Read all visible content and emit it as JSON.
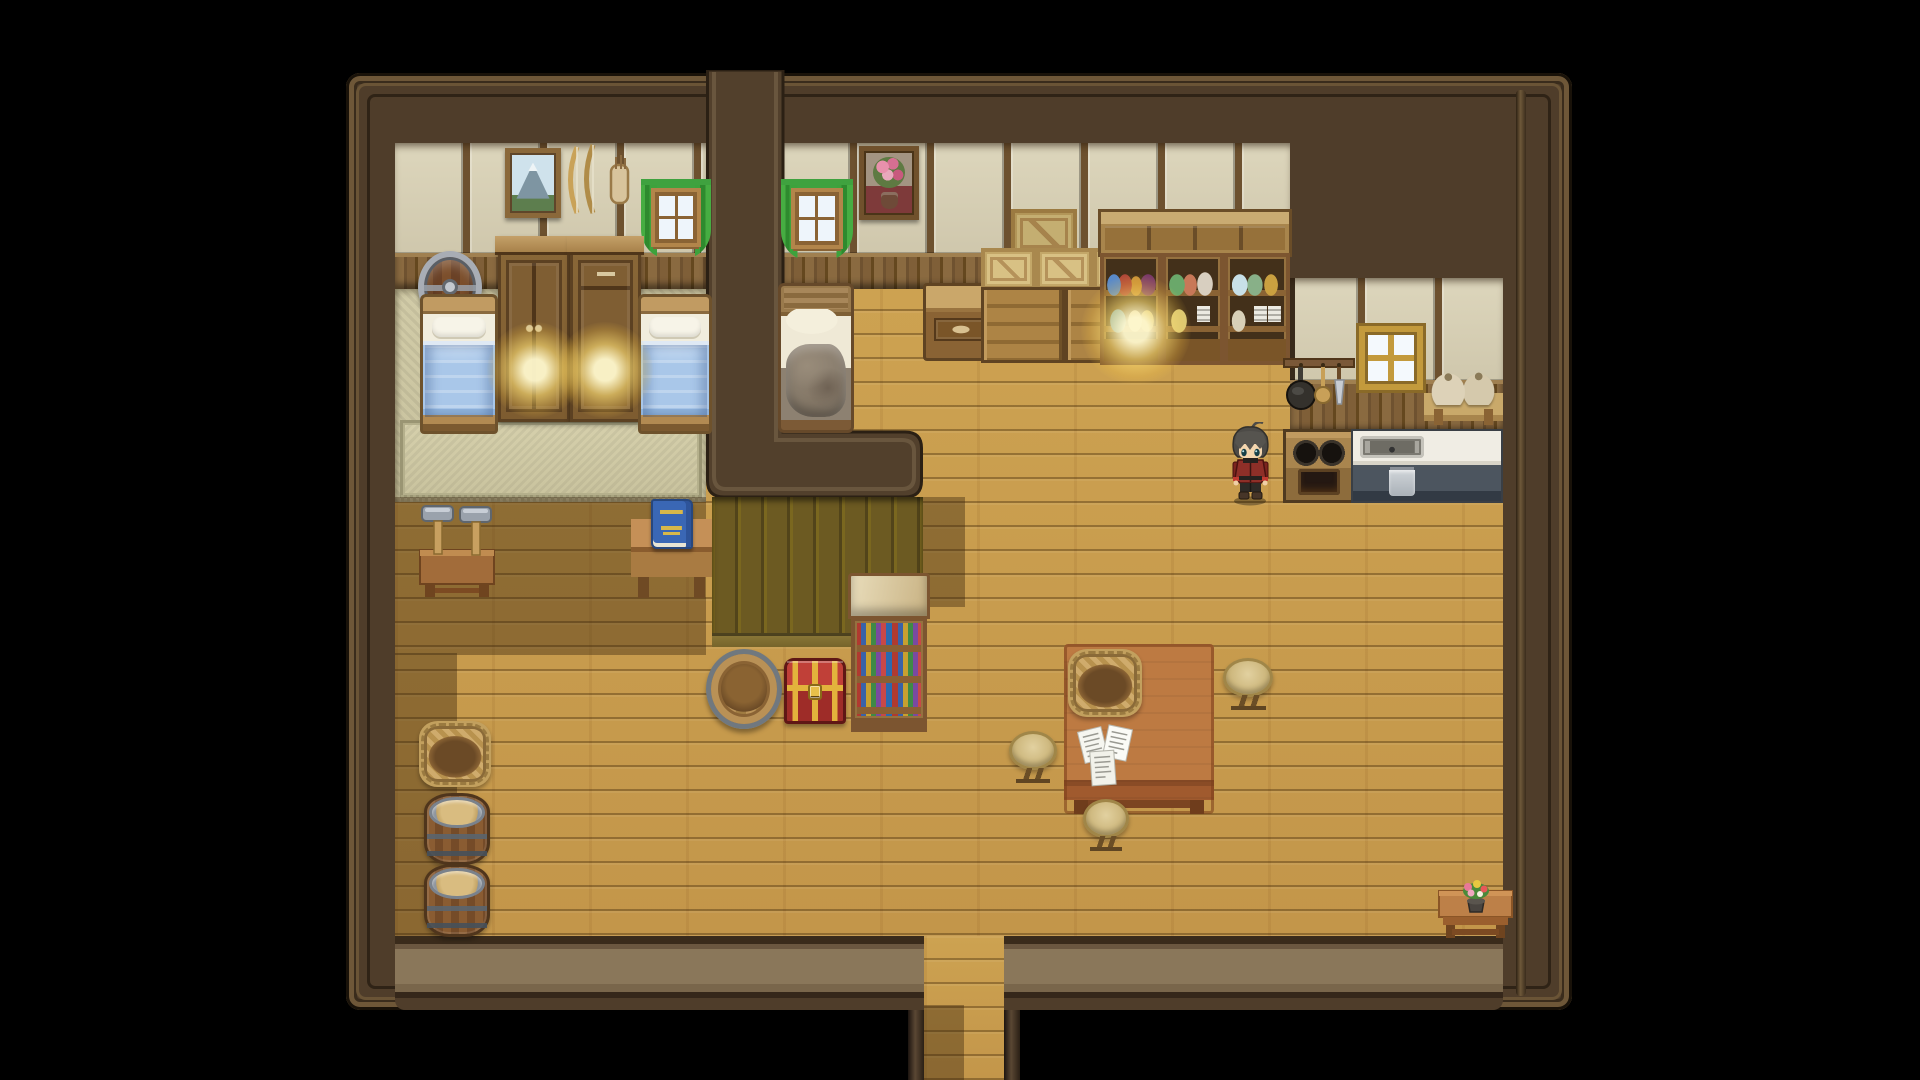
{
  "meta": {
    "title": "rpg-house-interior-scene",
    "width": 1920,
    "height": 1080,
    "background": "#000000"
  },
  "palette": {
    "void": "#000000",
    "wall": "#4f3d2a",
    "wall_edge": "#191209",
    "wall_trim": "#6e5738",
    "floor_light": "#cda251",
    "floor_shadow": "#8f7136",
    "wallpaper": "#d8d1b6",
    "wainscot": "#7a5a34",
    "platform_olive": "#6c5a22",
    "mat": "#ccc6a2",
    "curtain_green": "#3da23c",
    "blanket_blue": "#a9c7e9",
    "blanket_messy": "#8d8171",
    "chest_red": "#c04038",
    "chest_gold": "#e3b33c",
    "counter_white": "#f0ede4",
    "counter_base": "#4c555f",
    "lamp_glow": "#ffe073",
    "book_blue": "#3a67b5",
    "hair_gray": "#4d4b47",
    "coat_red": "#8e2f28"
  },
  "layers": [
    {
      "name": "house-base",
      "type": "house-base",
      "x": 346,
      "y": 73,
      "w": 1226,
      "h": 937,
      "interactable": false
    },
    {
      "name": "house-inner-trim",
      "type": "inner-trim",
      "x": 356,
      "y": 83,
      "w": 1206,
      "h": 917,
      "interactable": false
    },
    {
      "name": "right-wall-ridge",
      "type": "trim-ridge",
      "x": 1516,
      "y": 90,
      "w": 10,
      "h": 906,
      "interactable": false
    },
    {
      "name": "hall-floor",
      "type": "floor-wood",
      "x": 395,
      "y": 287,
      "w": 1108,
      "h": 649,
      "interactable": true
    },
    {
      "name": "bottom-wall-band",
      "type": "bottom-band",
      "x": 395,
      "y": 936,
      "w": 1108,
      "h": 74,
      "interactable": false
    },
    {
      "name": "exit-corridor-floor",
      "type": "floor-wood",
      "x": 924,
      "y": 936,
      "w": 80,
      "h": 144,
      "interactable": true
    },
    {
      "name": "corridor-wall-left",
      "type": "corridor-wall",
      "x": 908,
      "y": 1010,
      "w": 16,
      "h": 70,
      "interactable": false
    },
    {
      "name": "corridor-wall-right",
      "type": "corridor-wall",
      "x": 1004,
      "y": 1010,
      "w": 16,
      "h": 70,
      "interactable": false
    },
    {
      "name": "bedroom-left-mat-floor",
      "type": "mat-floor",
      "x": 395,
      "y": 287,
      "w": 311,
      "h": 215,
      "interactable": false
    },
    {
      "name": "bedroom-left-rug",
      "type": "rug",
      "x": 400,
      "y": 420,
      "w": 302,
      "h": 78,
      "interactable": false
    },
    {
      "name": "bedroom-left-wallpaper",
      "type": "wallpaper",
      "x": 395,
      "y": 143,
      "w": 311,
      "h": 112,
      "interactable": false
    },
    {
      "name": "bedroom-left-wainscot",
      "type": "wainscot",
      "x": 395,
      "y": 253,
      "w": 311,
      "h": 36,
      "interactable": false
    },
    {
      "name": "bedroom-mid-wallpaper",
      "type": "wallpaper",
      "x": 782,
      "y": 143,
      "w": 508,
      "h": 112,
      "interactable": false
    },
    {
      "name": "bedroom-mid-wainscot",
      "type": "wainscot",
      "x": 782,
      "y": 253,
      "w": 508,
      "h": 36,
      "interactable": false
    },
    {
      "name": "kitchen-wallpaper",
      "type": "wallpaper",
      "variant": "kitchen",
      "x": 1290,
      "y": 278,
      "w": 213,
      "h": 104,
      "interactable": false
    },
    {
      "name": "kitchen-wainscot",
      "type": "wainscot",
      "x": 1290,
      "y": 380,
      "w": 213,
      "h": 53,
      "interactable": false
    },
    {
      "name": "divider-wall",
      "type": "divider-wall",
      "x": 706,
      "y": 70,
      "w": 219,
      "h": 430,
      "interactable": false
    },
    {
      "name": "raised-platform-face",
      "type": "platform",
      "x": 712,
      "y": 497,
      "w": 211,
      "h": 150,
      "interactable": false
    },
    {
      "name": "shadow-under-bedroom",
      "type": "shadow-rect",
      "x": 395,
      "y": 497,
      "w": 311,
      "h": 158,
      "interactable": false
    },
    {
      "name": "shadow-left-wall",
      "type": "shadow-rect",
      "x": 395,
      "y": 653,
      "w": 62,
      "h": 283,
      "interactable": false
    },
    {
      "name": "shadow-platform-right",
      "type": "shadow-rect",
      "x": 923,
      "y": 497,
      "w": 42,
      "h": 110,
      "interactable": false
    },
    {
      "name": "shadow-corridor",
      "type": "shadow-rect",
      "x": 924,
      "y": 1005,
      "w": 40,
      "h": 75,
      "interactable": false
    },
    {
      "name": "painting-mountain",
      "type": "painting-mountain",
      "x": 505,
      "y": 148,
      "w": 56,
      "h": 70,
      "interactable": false
    },
    {
      "name": "bow-rack",
      "type": "bow-rack",
      "x": 563,
      "y": 141,
      "w": 76,
      "h": 84,
      "interactable": false
    },
    {
      "name": "window-bedroom-left",
      "type": "window-green",
      "x": 641,
      "y": 179,
      "w": 70,
      "h": 80,
      "interactable": false
    },
    {
      "name": "barrel-shield",
      "type": "barrel-shield",
      "x": 418,
      "y": 251,
      "w": 64,
      "h": 72,
      "interactable": false
    },
    {
      "name": "armoire",
      "type": "armoire",
      "x": 498,
      "y": 236,
      "w": 72,
      "h": 186,
      "interactable": false
    },
    {
      "name": "dresser-tall",
      "type": "dresser-tall",
      "x": 570,
      "y": 236,
      "w": 71,
      "h": 186,
      "interactable": false
    },
    {
      "name": "bed-blue-left",
      "type": "bed-blue",
      "x": 420,
      "y": 294,
      "w": 78,
      "h": 140,
      "interactable": false
    },
    {
      "name": "bed-blue-right",
      "type": "bed-blue",
      "x": 638,
      "y": 294,
      "w": 74,
      "h": 140,
      "interactable": false
    },
    {
      "name": "window-bedroom-mid",
      "type": "window-green",
      "x": 781,
      "y": 179,
      "w": 72,
      "h": 82,
      "interactable": false
    },
    {
      "name": "painting-flowers",
      "type": "painting-flowers",
      "x": 859,
      "y": 146,
      "w": 60,
      "h": 74,
      "interactable": false
    },
    {
      "name": "bed-messy",
      "type": "bed-messy",
      "x": 778,
      "y": 283,
      "w": 76,
      "h": 150,
      "interactable": false
    },
    {
      "name": "side-desk",
      "type": "side-desk",
      "x": 923,
      "y": 283,
      "w": 76,
      "h": 78,
      "interactable": false
    },
    {
      "name": "crate-big",
      "type": "crate",
      "variant": "big",
      "x": 1011,
      "y": 209,
      "w": 66,
      "h": 48,
      "interactable": false
    },
    {
      "name": "crate-1",
      "type": "crate",
      "x": 981,
      "y": 248,
      "w": 55,
      "h": 42,
      "interactable": false
    },
    {
      "name": "crate-2",
      "type": "crate",
      "x": 1036,
      "y": 248,
      "w": 57,
      "h": 42,
      "interactable": false
    },
    {
      "name": "crate-3",
      "type": "crate",
      "x": 1093,
      "y": 248,
      "w": 54,
      "h": 42,
      "interactable": false
    },
    {
      "name": "dresser-wide-1",
      "type": "dresser-wide",
      "x": 981,
      "y": 287,
      "w": 84,
      "h": 76,
      "interactable": false
    },
    {
      "name": "dresser-wide-2",
      "type": "dresser-wide",
      "x": 1065,
      "y": 287,
      "w": 82,
      "h": 76,
      "interactable": false
    },
    {
      "name": "upper-cabinet",
      "type": "upper-cabinet",
      "x": 1098,
      "y": 209,
      "w": 194,
      "h": 48,
      "interactable": false
    },
    {
      "name": "hutch-jars",
      "type": "hutch",
      "variant": "v-jars1",
      "x": 1100,
      "y": 253,
      "w": 62,
      "h": 112,
      "interactable": false
    },
    {
      "name": "hutch-bottles",
      "type": "hutch",
      "variant": "v-jars2",
      "x": 1162,
      "y": 253,
      "w": 62,
      "h": 112,
      "interactable": false
    },
    {
      "name": "hutch-plates",
      "type": "hutch",
      "variant": "v-plates",
      "x": 1224,
      "y": 253,
      "w": 66,
      "h": 112,
      "interactable": false
    },
    {
      "name": "window-kitchen",
      "type": "window-plain",
      "x": 1359,
      "y": 326,
      "w": 64,
      "h": 64,
      "interactable": false
    },
    {
      "name": "pan-rack",
      "type": "pan-rack",
      "x": 1283,
      "y": 354,
      "w": 72,
      "h": 72,
      "interactable": false
    },
    {
      "name": "sack-shelf",
      "type": "sack-shelf",
      "x": 1424,
      "y": 371,
      "w": 79,
      "h": 54,
      "interactable": false
    },
    {
      "name": "stove",
      "type": "stove",
      "x": 1283,
      "y": 429,
      "w": 72,
      "h": 74,
      "interactable": true
    },
    {
      "name": "sink-counter",
      "type": "sink-counter",
      "x": 1351,
      "y": 429,
      "w": 152,
      "h": 74,
      "interactable": true
    },
    {
      "name": "bookshelf",
      "type": "bookshelf",
      "x": 851,
      "y": 573,
      "w": 76,
      "h": 159,
      "interactable": true
    },
    {
      "name": "hammer-stand",
      "type": "hammer-stand",
      "x": 418,
      "y": 498,
      "w": 78,
      "h": 102,
      "interactable": false
    },
    {
      "name": "book-desk",
      "type": "book-desk",
      "x": 631,
      "y": 499,
      "w": 81,
      "h": 99,
      "interactable": true
    },
    {
      "name": "washtub",
      "type": "washtub",
      "x": 706,
      "y": 649,
      "w": 76,
      "h": 80,
      "interactable": false
    },
    {
      "name": "treasure-chest",
      "type": "chest",
      "x": 784,
      "y": 658,
      "w": 62,
      "h": 66,
      "interactable": true
    },
    {
      "name": "dining-table",
      "type": "table-big",
      "x": 1064,
      "y": 644,
      "w": 150,
      "h": 170,
      "interactable": false
    },
    {
      "name": "basket-on-table",
      "type": "basket",
      "x": 1068,
      "y": 649,
      "w": 74,
      "h": 68,
      "interactable": false
    },
    {
      "name": "papers",
      "type": "papers",
      "x": 1073,
      "y": 723,
      "w": 62,
      "h": 66,
      "interactable": true
    },
    {
      "name": "stool-right",
      "type": "stool",
      "x": 1223,
      "y": 658,
      "w": 50,
      "h": 52,
      "interactable": false
    },
    {
      "name": "stool-left",
      "type": "stool",
      "x": 1009,
      "y": 731,
      "w": 48,
      "h": 52,
      "interactable": false
    },
    {
      "name": "stool-bottom",
      "type": "stool",
      "x": 1083,
      "y": 799,
      "w": 46,
      "h": 52,
      "interactable": false
    },
    {
      "name": "basket-floor",
      "type": "basket",
      "x": 419,
      "y": 721,
      "w": 72,
      "h": 66,
      "interactable": false
    },
    {
      "name": "barrel-1",
      "type": "barrel-floor",
      "x": 424,
      "y": 793,
      "w": 66,
      "h": 72,
      "interactable": false
    },
    {
      "name": "barrel-2",
      "type": "barrel-floor",
      "x": 424,
      "y": 864,
      "w": 66,
      "h": 73,
      "interactable": false
    },
    {
      "name": "flower-table",
      "type": "flower-table",
      "x": 1437,
      "y": 863,
      "w": 77,
      "h": 78,
      "interactable": false
    },
    {
      "name": "lamp-glow-left",
      "type": "glow",
      "x": 487,
      "y": 322,
      "w": 96,
      "h": 96,
      "interactable": false
    },
    {
      "name": "lamp-glow-right",
      "type": "glow",
      "x": 557,
      "y": 322,
      "w": 96,
      "h": 96,
      "interactable": false
    },
    {
      "name": "lamp-glow-shelf",
      "type": "glow",
      "x": 1081,
      "y": 275,
      "w": 110,
      "h": 110,
      "interactable": false
    },
    {
      "name": "player-character",
      "type": "character",
      "x": 1226,
      "y": 422,
      "w": 49,
      "h": 84,
      "interactable": true
    }
  ]
}
